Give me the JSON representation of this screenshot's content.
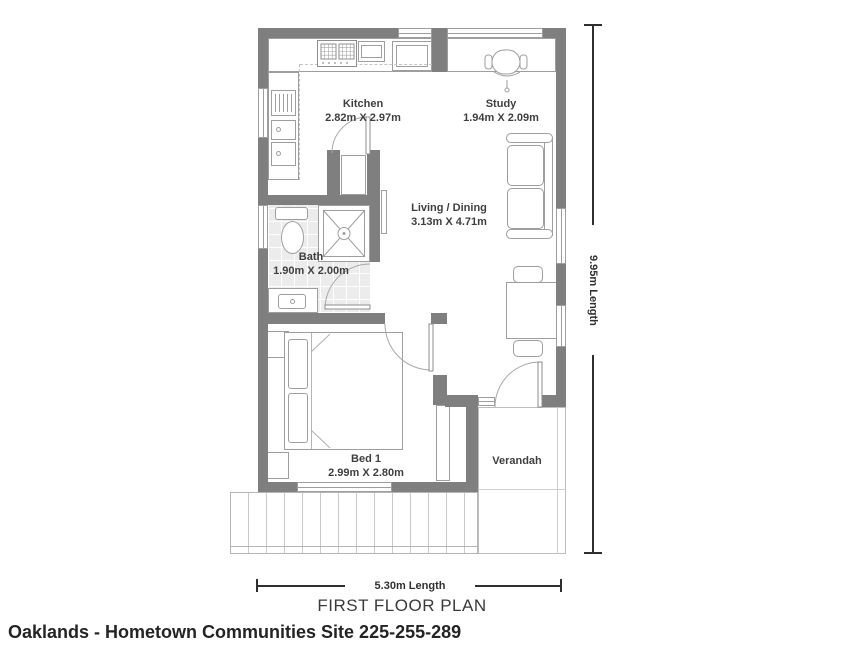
{
  "plan": {
    "title": "FIRST FLOOR PLAN",
    "caption": "Oaklands - Hometown Communities Site 225-255-289",
    "rooms": [
      {
        "name": "Kitchen",
        "dims": "2.82m X 2.97m"
      },
      {
        "name": "Study",
        "dims": "1.94m X 2.09m"
      },
      {
        "name": "Living / Dining",
        "dims": "3.13m X 4.71m"
      },
      {
        "name": "Bath",
        "dims": "1.90m X 2.00m"
      },
      {
        "name": "Bed 1",
        "dims": "2.99m X 2.80m"
      },
      {
        "name": "Verandah",
        "dims": ""
      }
    ],
    "dimensions": {
      "height_label": "9.95m Length",
      "width_label": "5.30m Length"
    },
    "colors": {
      "wall": "#7f7f7f",
      "furniture_outline": "#9e9e9e",
      "bath_tile": "#ececec",
      "dimension_line": "#2f2f2f",
      "label_text": "#3f3f3f"
    }
  }
}
